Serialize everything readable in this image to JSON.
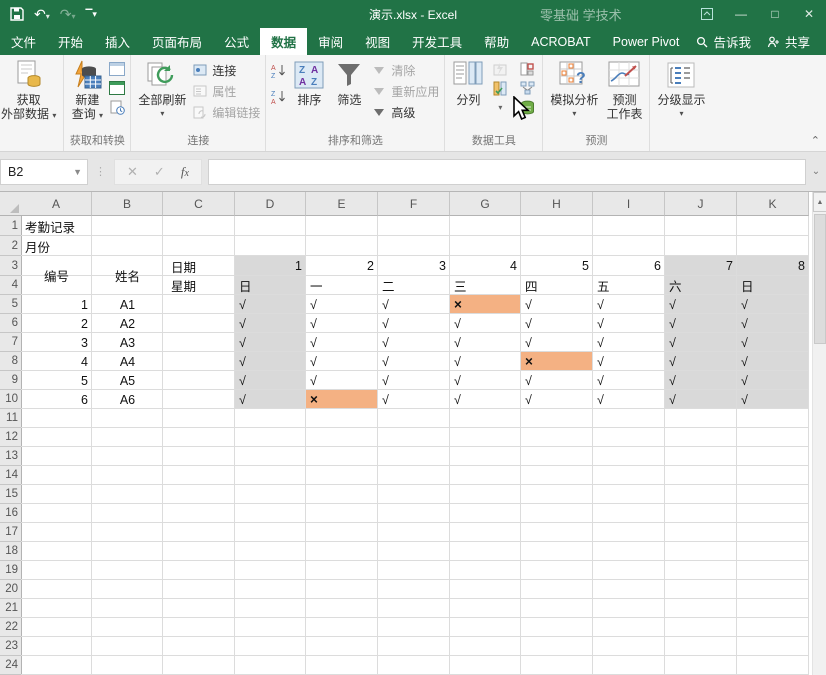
{
  "title_bar": {
    "title": "演示.xlsx - Excel",
    "watermark": "零基础 学技术",
    "quick_access": [
      "save-icon",
      "undo-icon",
      "redo-icon",
      "customize-qat-icon"
    ],
    "window_buttons": [
      "ribbon-display-options",
      "minimize",
      "maximize",
      "close"
    ]
  },
  "ribbon_tabs": [
    {
      "label": "文件"
    },
    {
      "label": "开始"
    },
    {
      "label": "插入"
    },
    {
      "label": "页面布局"
    },
    {
      "label": "公式"
    },
    {
      "label": "数据"
    },
    {
      "label": "审阅"
    },
    {
      "label": "视图"
    },
    {
      "label": "开发工具"
    },
    {
      "label": "帮助"
    },
    {
      "label": "ACROBAT"
    },
    {
      "label": "Power Pivot"
    }
  ],
  "active_tab": "数据",
  "tab_right": {
    "tell_me": "告诉我",
    "share": "共享"
  },
  "ribbon": {
    "get_external": {
      "line1": "获取",
      "line2": "外部数据"
    },
    "group_transform": {
      "label": "获取和转换",
      "new_query1": "新建",
      "new_query2": "查询"
    },
    "group_connections": {
      "label": "连接",
      "refresh_all": "全部刷新",
      "connections": "连接",
      "properties": "属性",
      "edit_links": "编辑链接"
    },
    "group_sort": {
      "label": "排序和筛选",
      "sort": "排序",
      "filter": "筛选",
      "clear": "清除",
      "reapply": "重新应用",
      "advanced": "高级"
    },
    "group_tools": {
      "label": "数据工具",
      "text_to_columns": "分列"
    },
    "group_forecast": {
      "label": "预测",
      "what_if": "模拟分析",
      "forecast1": "预测",
      "forecast2": "工作表"
    },
    "group_outline": {
      "outline": "分级显示"
    }
  },
  "formula_bar": {
    "name_box": "B2",
    "formula": ""
  },
  "sheet": {
    "columns": [
      "A",
      "B",
      "C",
      "D",
      "E",
      "F",
      "G",
      "H",
      "I",
      "J",
      "K"
    ],
    "row_count": 24,
    "title": "考勤记录",
    "month_label": "月份",
    "header": {
      "id": "编号",
      "name": "姓名",
      "date": "日期",
      "week": "星期",
      "dates": [
        "1",
        "2",
        "3",
        "4",
        "5",
        "6",
        "7",
        "8"
      ],
      "days": [
        "日",
        "一",
        "二",
        "三",
        "四",
        "五",
        "六",
        "日"
      ]
    },
    "weekend_day_indices": [
      0,
      6,
      7
    ],
    "records": [
      {
        "id": "1",
        "name": "A1",
        "marks": [
          "√",
          "√",
          "√",
          "×",
          "√",
          "√",
          "√",
          "√"
        ]
      },
      {
        "id": "2",
        "name": "A2",
        "marks": [
          "√",
          "√",
          "√",
          "√",
          "√",
          "√",
          "√",
          "√"
        ]
      },
      {
        "id": "3",
        "name": "A3",
        "marks": [
          "√",
          "√",
          "√",
          "√",
          "√",
          "√",
          "√",
          "√"
        ]
      },
      {
        "id": "4",
        "name": "A4",
        "marks": [
          "√",
          "√",
          "√",
          "√",
          "×",
          "√",
          "√",
          "√"
        ]
      },
      {
        "id": "5",
        "name": "A5",
        "marks": [
          "√",
          "√",
          "√",
          "√",
          "√",
          "√",
          "√",
          "√"
        ]
      },
      {
        "id": "6",
        "name": "A6",
        "marks": [
          "√",
          "×",
          "√",
          "√",
          "√",
          "√",
          "√",
          "√"
        ]
      }
    ],
    "colors": {
      "weekend_fill": "#d9d9d9",
      "absent_fill": "#f4b183",
      "accent_green": "#217346"
    }
  }
}
